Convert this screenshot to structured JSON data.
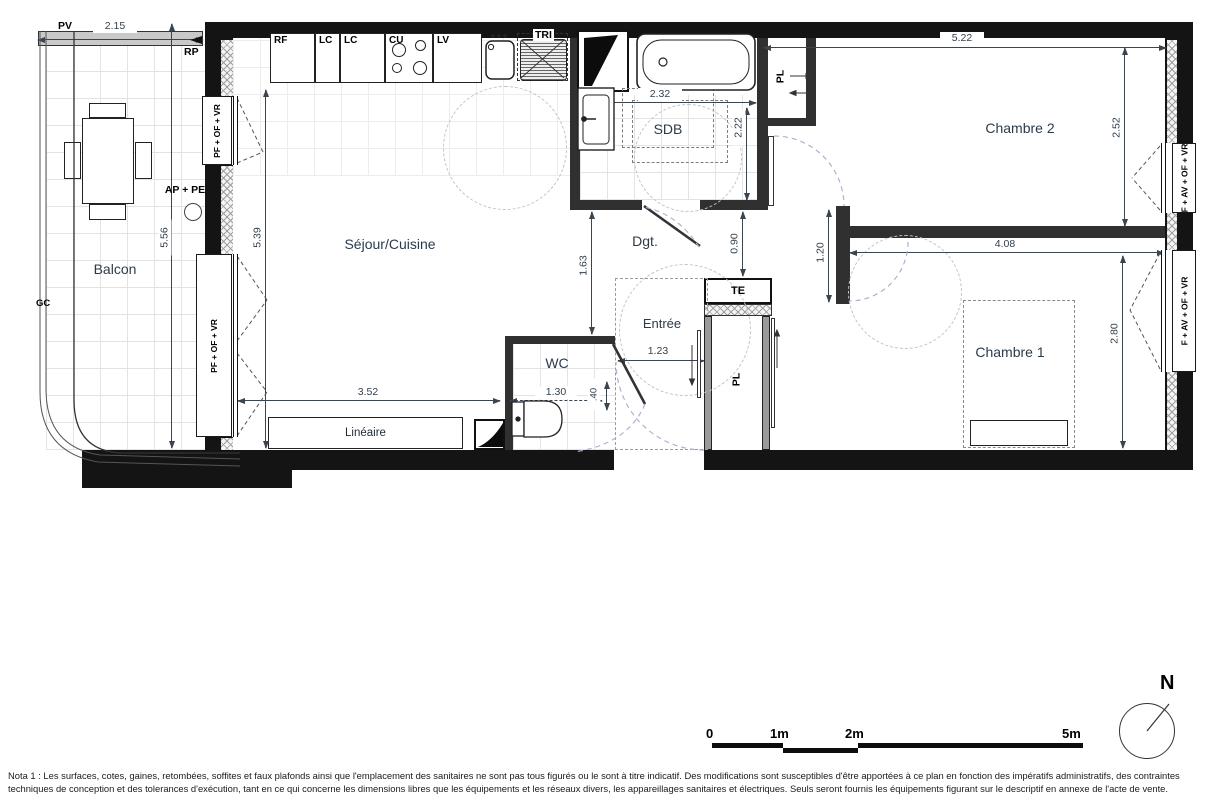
{
  "rooms": {
    "balcon": "Balcon",
    "sejour": "Séjour/Cuisine",
    "sdb": "SDB",
    "dgt": "Dgt.",
    "entree": "Entrée",
    "wc": "WC",
    "chambre1": "Chambre 1",
    "chambre2": "Chambre 2"
  },
  "fixtures": {
    "lineaire": "Linéaire",
    "te": "TE",
    "pl_chambre2": "PL",
    "pl_entree": "PL",
    "tri": "TRI"
  },
  "kitchen_units": [
    "RF",
    "LC",
    "LC",
    "CU",
    "LV"
  ],
  "wall_labels": {
    "pv": "PV",
    "rp": "RP",
    "gc": "GC",
    "ap_pe": "AP + PE",
    "window_left_top": "PF + OF + VR",
    "window_left_bottom": "PF + OF + VR",
    "window_chambre2": "F + AV + OF + VR",
    "window_chambre1": "F + AV + OF + VR"
  },
  "dimensions": {
    "balcon_width": "2.15",
    "balcon_height": "5.56",
    "sejour_height": "5.39",
    "sdb_width": "2.32",
    "sdb_height": "2.22",
    "dgt_height": "1.63",
    "hall_height": "0.90",
    "wall_length": "1.20",
    "chambre2_width": "5.22",
    "chambre2_height": "2.52",
    "chambre1_width": "4.08",
    "chambre1_height": "2.80",
    "lineaire_width": "3.52",
    "wc_width": "1.30",
    "wc_offset": ".40",
    "entree_width": "1.23"
  },
  "scale_bar": {
    "tick0": "0",
    "tick1": "1m",
    "tick2": "2m",
    "tick5": "5m"
  },
  "north": {
    "label": "N"
  },
  "nota": "Nota 1 : Les surfaces, cotes, gaines, retombées, soffites et faux plafonds ainsi que l'emplacement des sanitaires ne sont pas tous figurés ou le sont à titre indicatif. Des modifications sont susceptibles d'être apportées à ce plan en fonction des impératifs administratifs, des contraintes techniques de conception et des tolerances d'exécution, tant en ce qui concerne les dimensions libres que les équipements et les réseaux divers, les appareillages sanitaires et électriques. Seuls seront fournis les équipements figurant sur le descriptif en annexe de l'acte de vente."
}
